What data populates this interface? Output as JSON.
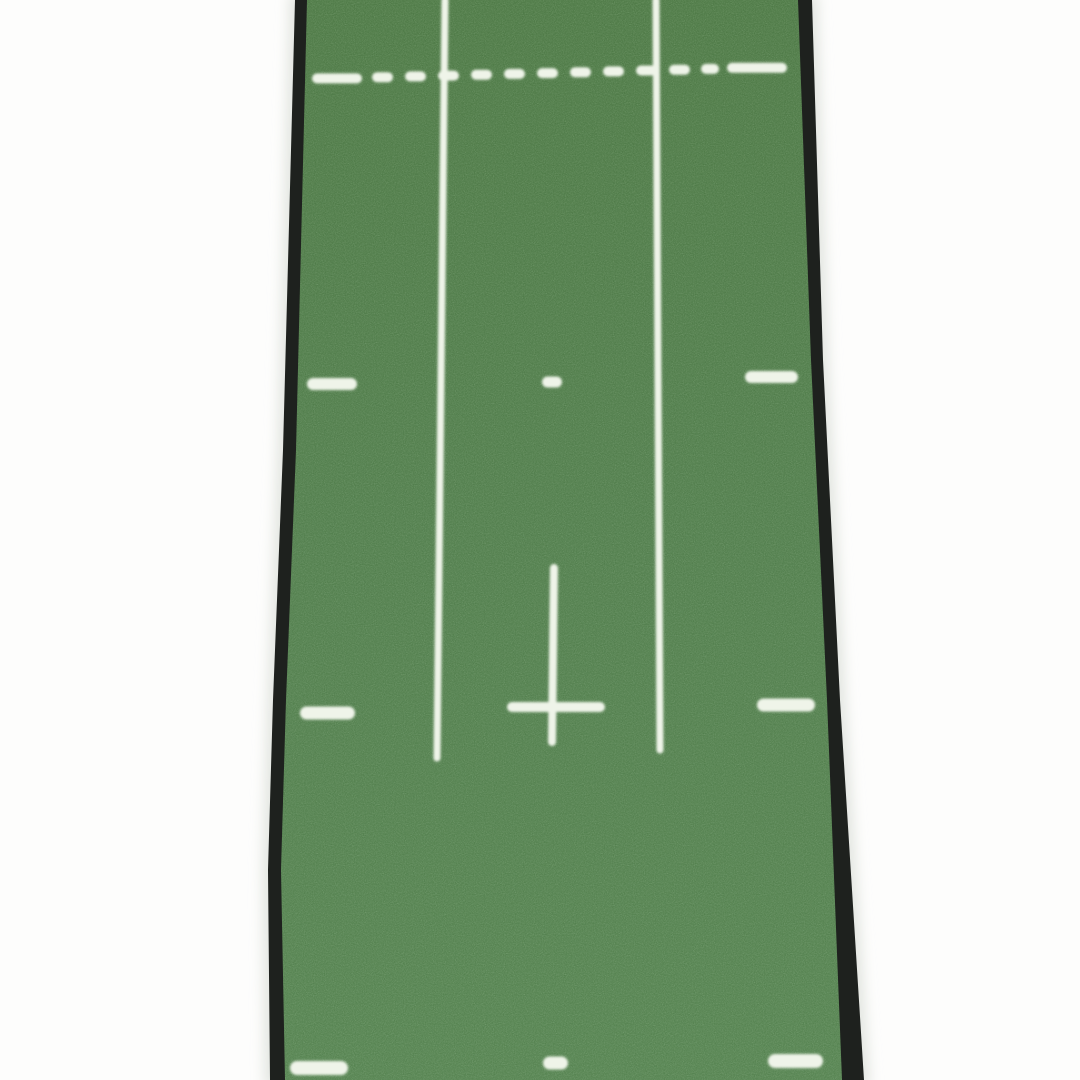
{
  "scene": {
    "subject": "Green indoor golf putting practice mat runner with white alignment markings, photographed from above on a white background",
    "background_color": "#fdfdfc",
    "shadow_color": "#e3e6e1"
  },
  "mat": {
    "binding_color": "#1e211e",
    "turf_gradient": {
      "top": "#4a7642",
      "mid": "#4e7b49",
      "bottom": "#52804d"
    },
    "marking_color": "#eff4e9",
    "outer_path": "M295,0 L283,450 L273,700 L268,870 L270,1080 L864,1080 L840,700 L823,360 L812,0 Z",
    "turf_path": "M307,0 L296,450 L286,700 L281,870 L285,1080 L842,1080 L827,700 L811,360 L798,0 Z"
  },
  "markings": {
    "marking_blur_px": 1.4,
    "dashed_line": {
      "thickness": 10,
      "x_left": 312,
      "y_left_center": 79,
      "x_right": 787,
      "y_right_center": 67,
      "dashes": [
        [
          312,
          50
        ],
        [
          372,
          21
        ],
        [
          405,
          21
        ],
        [
          438,
          21
        ],
        [
          471,
          21
        ],
        [
          504,
          21
        ],
        [
          537,
          21
        ],
        [
          570,
          21
        ],
        [
          603,
          21
        ],
        [
          636,
          21
        ],
        [
          669,
          21
        ],
        [
          701,
          18
        ],
        [
          727,
          60
        ]
      ]
    },
    "guide_lines": [
      {
        "name": "left-guide-line",
        "x1": 445,
        "y1": 0,
        "x2": 437,
        "y2": 758,
        "width": 7
      },
      {
        "name": "right-guide-line",
        "x1": 656,
        "y1": 0,
        "x2": 660,
        "y2": 750,
        "width": 7
      },
      {
        "name": "center-target-line",
        "x1": 554,
        "y1": 568,
        "x2": 552,
        "y2": 742,
        "width": 8
      },
      {
        "name": "cross-bar",
        "x1": 512,
        "y1": 707,
        "x2": 600,
        "y2": 707,
        "width": 10
      }
    ],
    "ticks": [
      {
        "name": "tick-mid-left",
        "x": 307,
        "y_center": 384,
        "w": 50,
        "h": 12
      },
      {
        "name": "tick-mid-center",
        "x": 542,
        "y_center": 382,
        "w": 20,
        "h": 11
      },
      {
        "name": "tick-mid-right",
        "x": 745,
        "y_center": 377,
        "w": 53,
        "h": 12
      },
      {
        "name": "tick-lower-left",
        "x": 300,
        "y_center": 713,
        "w": 55,
        "h": 13
      },
      {
        "name": "tick-lower-right",
        "x": 757,
        "y_center": 705,
        "w": 58,
        "h": 13
      },
      {
        "name": "tick-bottom-left",
        "x": 290,
        "y_center": 1068,
        "w": 58,
        "h": 14
      },
      {
        "name": "tick-bottom-center",
        "x": 543,
        "y_center": 1063,
        "w": 25,
        "h": 13
      },
      {
        "name": "tick-bottom-right",
        "x": 768,
        "y_center": 1061,
        "w": 55,
        "h": 14
      }
    ]
  }
}
